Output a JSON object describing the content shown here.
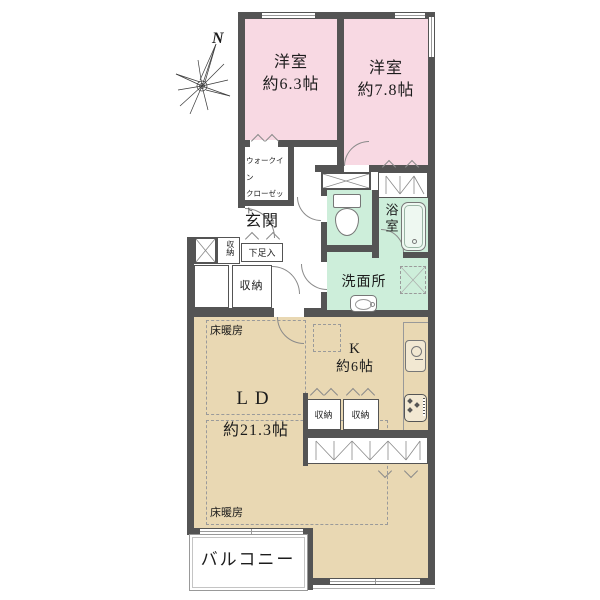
{
  "compass": {
    "north": "N"
  },
  "rooms": {
    "bedroom1": {
      "name": "洋室",
      "size": "約6.3帖"
    },
    "bedroom2": {
      "name": "洋室",
      "size": "約7.8帖"
    },
    "wic": {
      "line1": "ウォークイン",
      "line2": "クローゼット"
    },
    "entrance": {
      "name": "玄関",
      "shoe_box": "下足入",
      "storage": "収納"
    },
    "hall_storage": "収納",
    "bathroom": "浴室",
    "washroom": "洗面所",
    "living": {
      "name": "LD",
      "size": "約21.3帖",
      "floor_heating": "床暖房"
    },
    "kitchen": {
      "name": "K",
      "size": "約6帖",
      "storage1": "収納",
      "storage2": "収納"
    },
    "balcony": "バルコニー"
  },
  "colors": {
    "bedroom": "#f8d9e3",
    "wet_area": "#cdeeda",
    "living": "#e9d8b3",
    "wall": "#545454"
  }
}
